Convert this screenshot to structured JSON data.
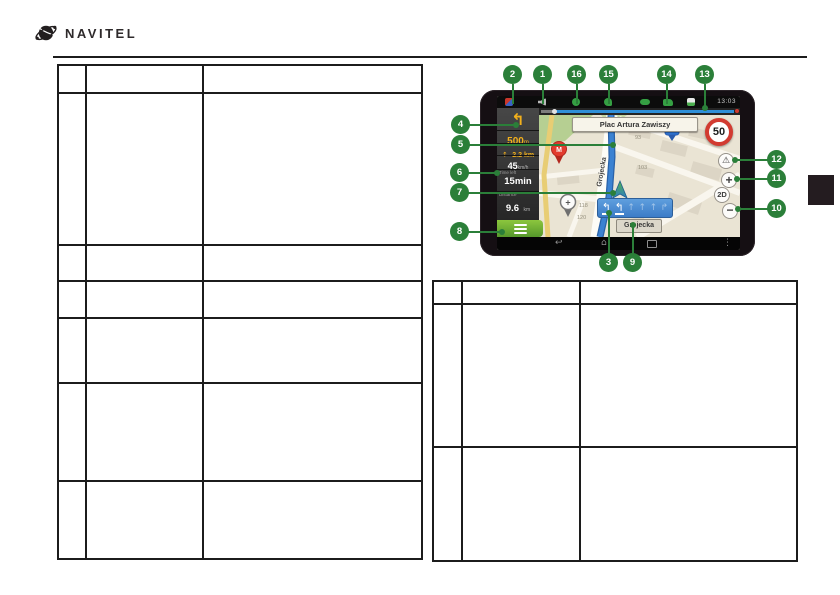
{
  "brand": {
    "name": "NAVITEL"
  },
  "callouts": [
    {
      "label": "1"
    },
    {
      "label": "2"
    },
    {
      "label": "3"
    },
    {
      "label": "4"
    },
    {
      "label": "5"
    },
    {
      "label": "6"
    },
    {
      "label": "7"
    },
    {
      "label": "8"
    },
    {
      "label": "9"
    },
    {
      "label": "10"
    },
    {
      "label": "11"
    },
    {
      "label": "12"
    },
    {
      "label": "13"
    },
    {
      "label": "14"
    },
    {
      "label": "15"
    },
    {
      "label": "16"
    }
  ],
  "device": {
    "status_bar": {
      "time": "13:03"
    },
    "panel": {
      "maneuver_distance": "500",
      "maneuver_distance_unit": "m",
      "next_maneuver_distance": "2.2 km",
      "speed": "45",
      "speed_unit": "km/h",
      "time_left_label": "Time left",
      "time_left": "15min",
      "distance_label": "Distance",
      "distance": "9.6",
      "distance_unit": "km"
    },
    "map": {
      "street_sign": "Plac Artura Zawiszy",
      "speed_limit": "50",
      "street_vertical": "Grojecka",
      "street_bottom": "Grojecka",
      "house_numbers": [
        "93",
        "103",
        "118",
        "120"
      ],
      "buttons": {
        "warning": "⚠",
        "zoom_in": "+",
        "view_mode": "2D",
        "zoom_out": "−"
      },
      "pois": {
        "metro": "M",
        "parking": "P",
        "pharmacy": "+"
      }
    },
    "lane_assist": {
      "arrows": [
        "↰",
        "↰",
        "↑",
        "↑",
        "↑",
        "↱"
      ]
    },
    "icons": {
      "maneuver_arrow": "↰",
      "next_arrow": "↑",
      "back": "↩",
      "home": "⌂",
      "menu_dots": "⋮"
    }
  }
}
